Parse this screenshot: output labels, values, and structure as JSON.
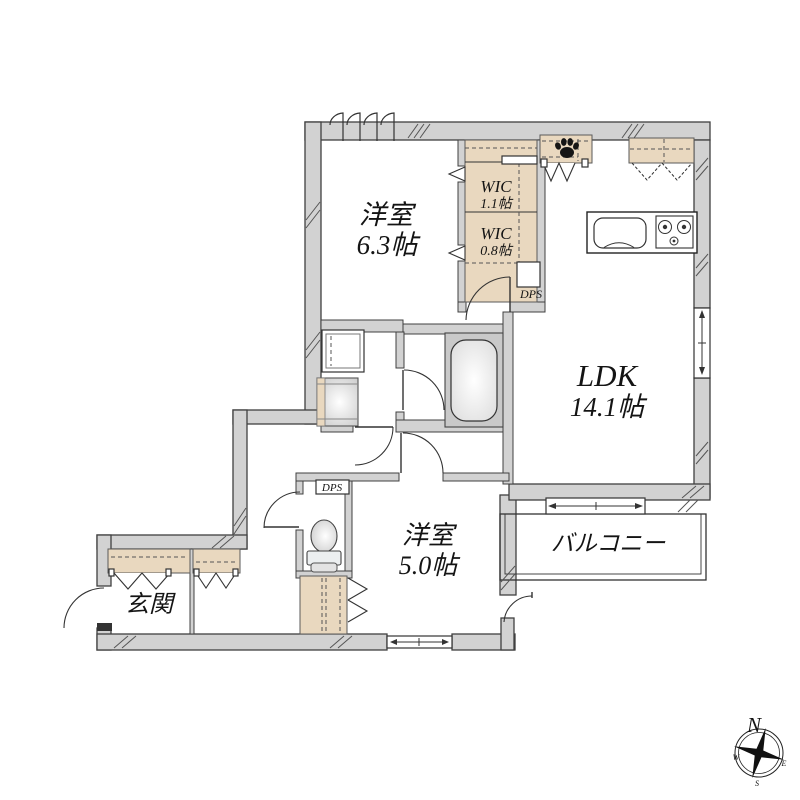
{
  "floorplan": {
    "rooms": {
      "bedroom_main": {
        "name": "洋室",
        "size": "6.3帖"
      },
      "bedroom_second": {
        "name": "洋室",
        "size": "5.0帖"
      },
      "ldk": {
        "name": "LDK",
        "size": "14.1帖"
      },
      "wic_large": {
        "name": "WIC",
        "size": "1.1帖"
      },
      "wic_small": {
        "name": "WIC",
        "size": "0.8帖"
      },
      "balcony": {
        "name": "バルコニー"
      },
      "entrance": {
        "name": "玄関"
      }
    },
    "labels": {
      "dps_upper": "DPS",
      "dps_lower": "DPS"
    },
    "compass": {
      "north": "N",
      "west": "W",
      "east": "E",
      "south": "S"
    },
    "colors": {
      "wall_fill": "#d2d2d2",
      "wall_stroke": "#404040",
      "storage_fill": "#e9d8bf",
      "fixture_gray": "#c9c9c9",
      "background": "#ffffff"
    }
  }
}
